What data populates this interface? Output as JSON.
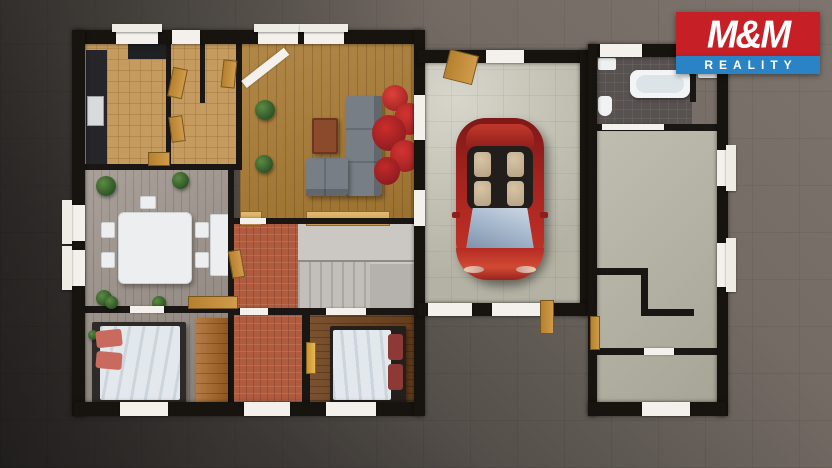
{
  "meta": {
    "description": "3D top-down architectural render of a furnished house ground floor plan on dark paved ground, with a red convertible car parked in the garage",
    "width": 832,
    "height": 468
  },
  "logo": {
    "title": "M&M",
    "subtitle": "REALITY",
    "colors": {
      "red": "#c62026",
      "blue": "#2a83c4",
      "text": "#ffffff"
    }
  },
  "scene": {
    "ground": {
      "light": "#7d746d",
      "dark": "#393532"
    },
    "walls": {
      "black": "#17130f",
      "white_cap": "#f4f1ec",
      "door_wood": "#c89045"
    },
    "floors": {
      "kitchen_tile": "#c59b5f",
      "living_wood": "#a87a33",
      "dining_wood": "#9c938b",
      "hall_tile": "#b05b3d",
      "bedroom_left_wood": "#8f867d",
      "bedroom_mid_wood": "#6f431e",
      "stairs_landing": "#cbc8c3",
      "stairs_lower": "#b5b2ad",
      "garage_concrete": "#c8c6b6",
      "bathroom_tile": "#575150",
      "utility_floor": "#b4b3a3"
    },
    "car": {
      "body": "#a62420",
      "windshield": "#aebfd2",
      "seats": "#c4b092",
      "cabin": "#221e1b"
    },
    "furniture": {
      "sofa": "#787e85",
      "coffee_table": "#8c4a2c",
      "dining_table": "#eceeef",
      "duvet": "#e3e8ec",
      "pillow_salmon": "#c96a5f",
      "pillow_darkred": "#8d3936",
      "wardrobe": "#a96526",
      "tree_red": "#c0272d",
      "plant_green": "#3c6a31",
      "counter_dark": "#26262a"
    },
    "objects": [
      "kitchen-counter",
      "dining-table",
      "dining-chairs",
      "sideboard",
      "sectional-sofa",
      "coffee-table",
      "autumn-tree",
      "potted-plants",
      "staircase",
      "double-bed-left",
      "double-bed-middle",
      "wardrobe",
      "red-convertible-car",
      "bathtub",
      "toilet",
      "washing-machine",
      "wooden-doors",
      "windows"
    ]
  }
}
